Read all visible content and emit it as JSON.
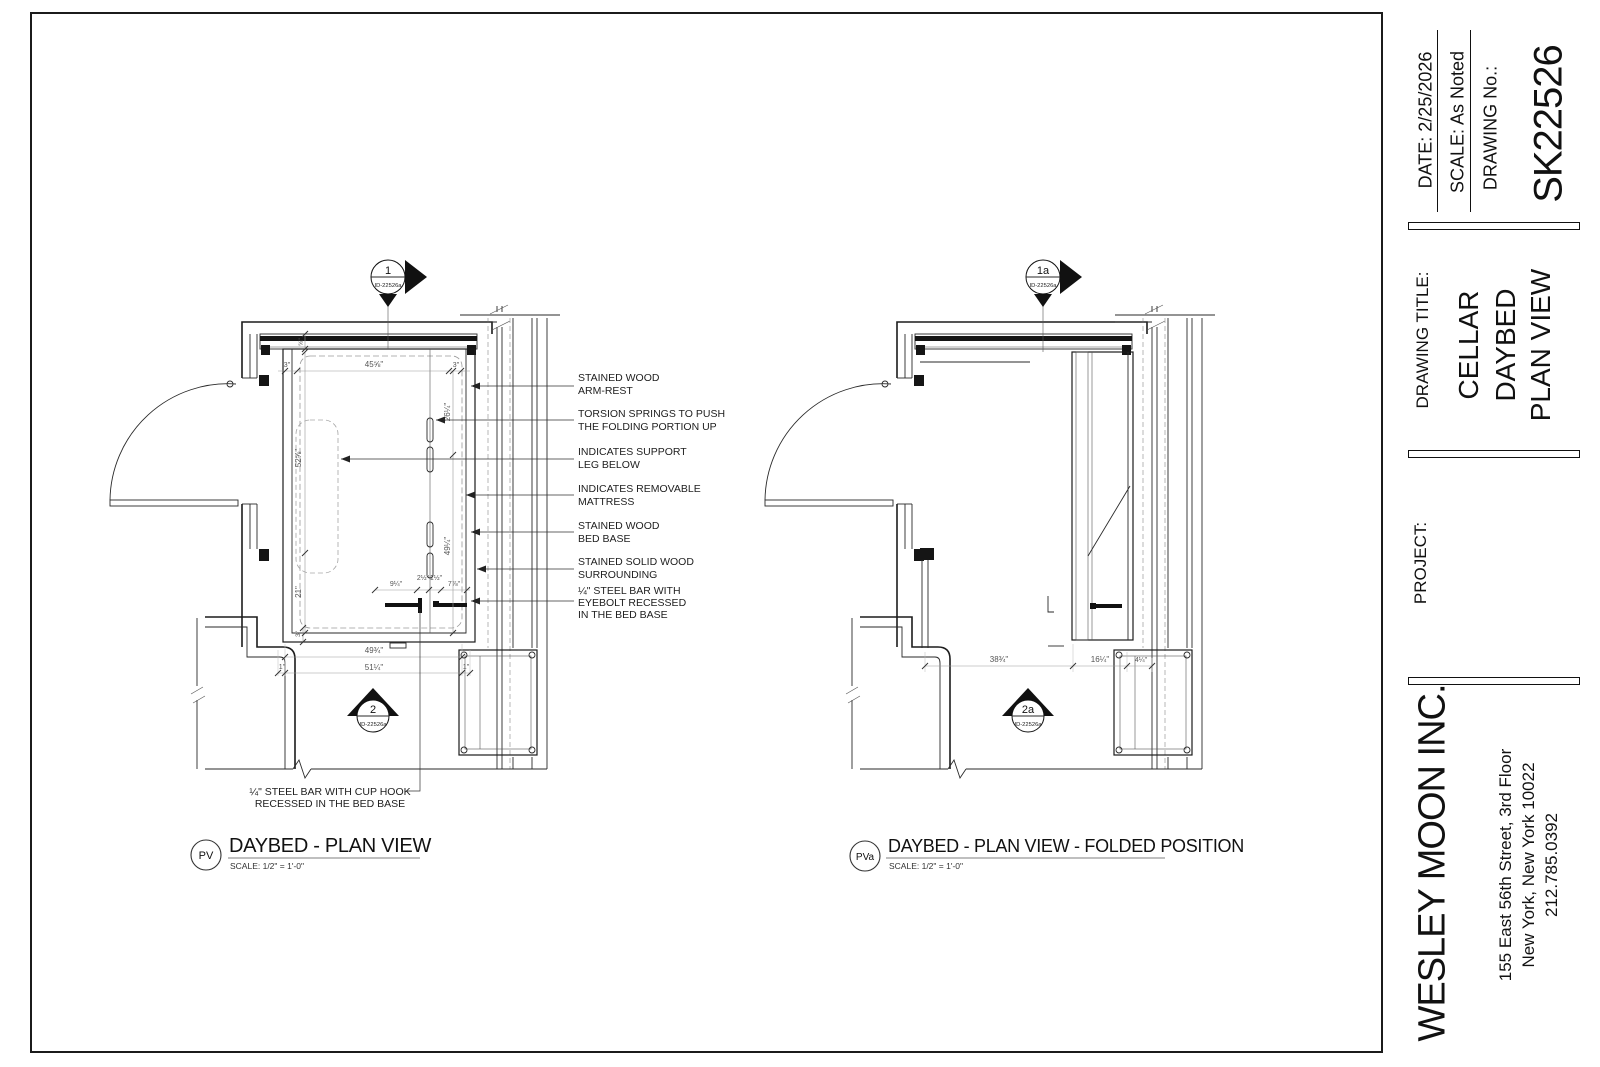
{
  "titleblock": {
    "date": "DATE: 2/25/2026",
    "scale": "SCALE: As Noted",
    "drawing_no_label": "DRAWING No.:",
    "drawing_no": "SK22526",
    "drawing_title_label": "DRAWING TITLE:",
    "title_line1": "CELLAR",
    "title_line2": "DAYBED",
    "title_line3": "PLAN VIEW",
    "project_label": "PROJECT:",
    "firm": "WESLEY MOON INC.",
    "address1": "155 East 56th Street, 3rd Floor",
    "address2": "New York, New York 10022",
    "phone": "212.785.0392"
  },
  "left": {
    "tag": "PV",
    "title": "DAYBED - PLAN VIEW",
    "scale_note": "SCALE: 1/2\" = 1'-0\"",
    "marker_top_num": "1",
    "marker_top_id": "ID-22526a",
    "marker_bot_num": "2",
    "marker_bot_id": "ID-22526a",
    "dims": {
      "reveal": "⅝\"",
      "side_l": "3\"",
      "top_width": "45⅝\"",
      "side_r": "3\"",
      "upper_left": "52⅝\"",
      "lower_left": "21\"",
      "upper_right": "26¼\"",
      "lower_right": "49¼\"",
      "bar_a": "9¼\"",
      "bar_b": "2½\"",
      "bar_c": "1½\"",
      "bar_d": "7⅞\"",
      "rail": "3\"",
      "inner_width": "49¾\"",
      "edge_l": "1\"",
      "edge_r": "1\"",
      "total_width": "51¼\""
    },
    "annotations": [
      [
        "STAINED WOOD",
        "ARM-REST"
      ],
      [
        "TORSION SPRINGS TO PUSH",
        "THE FOLDING PORTION UP"
      ],
      [
        "INDICATES SUPPORT",
        "LEG BELOW"
      ],
      [
        "INDICATES REMOVABLE",
        "MATTRESS"
      ],
      [
        "STAINED WOOD",
        "BED BASE"
      ],
      [
        "STAINED SOLID WOOD",
        "SURROUNDING"
      ],
      [
        "¼\" STEEL BAR WITH",
        "EYEBOLT RECESSED",
        "IN THE BED BASE"
      ]
    ],
    "note_line1": "¼\" STEEL BAR WITH CUP HOOK",
    "note_line2": "RECESSED IN THE BED BASE"
  },
  "right": {
    "tag": "PVa",
    "title": "DAYBED - PLAN VIEW - FOLDED POSITION",
    "scale_note": "SCALE: 1/2\" = 1'-0\"",
    "marker_top_num": "1a",
    "marker_top_id": "ID-22526a",
    "marker_bot_num": "2a",
    "marker_bot_id": "ID-22526a",
    "dims": {
      "clear": "38¾\"",
      "folded": "16¼\"",
      "unit": "4¼\""
    }
  }
}
